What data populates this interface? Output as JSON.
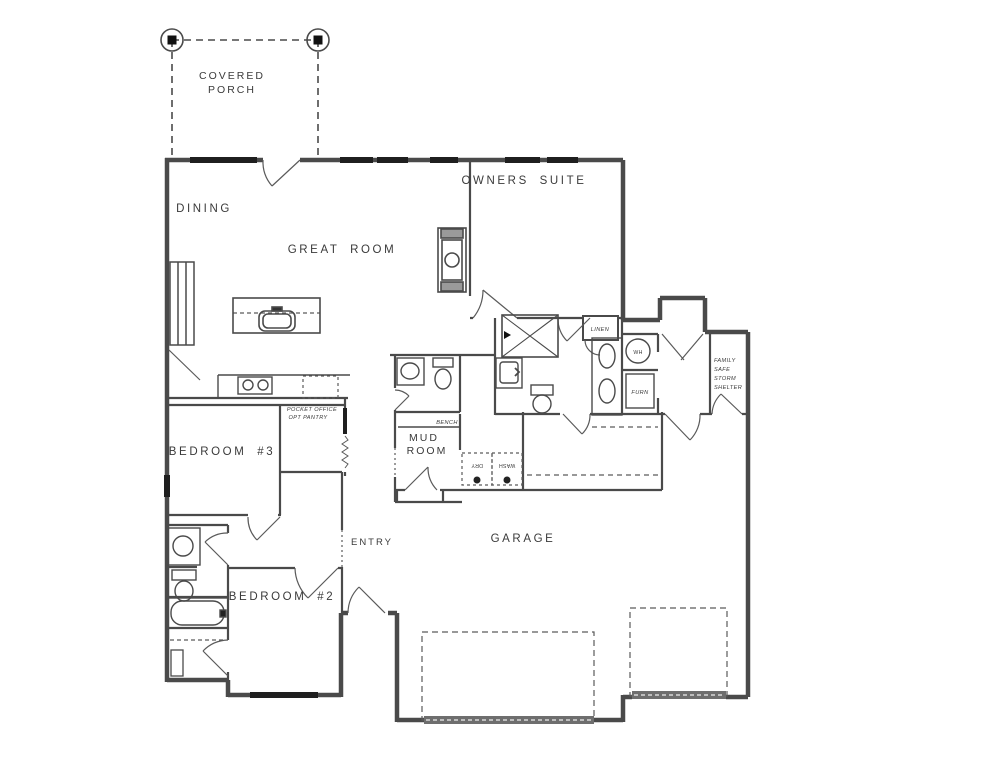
{
  "drawing_type": "residential floor plan",
  "labels": {
    "covered_porch": [
      "COVERED",
      "PORCH"
    ],
    "dining": "DINING",
    "great_room": "GREAT ROOM",
    "owners_suite": "OWNERS SUITE",
    "bedroom_3": "BEDROOM #3",
    "bedroom_2": "BEDROOM #2",
    "mud_room": [
      "MUD",
      "ROOM"
    ],
    "bench": "BENCH",
    "entry": "ENTRY",
    "garage": "GARAGE",
    "linen": "LINEN",
    "water_heater": "WH",
    "furnace": "FURN",
    "dryer": "DRY",
    "washer": "WASH",
    "pocket_office": [
      "POCKET OFFICE",
      "OPT PANTRY"
    ],
    "storm_shelter": [
      "FAMILY",
      "SAFE",
      "STORM",
      "SHELTER"
    ]
  },
  "colors": {
    "wall_line": "#4a4a4a",
    "window_fill": "#1f1f1f",
    "text": "#3a3a3a",
    "background": "#ffffff",
    "garage_door_band": "#6e6e6e"
  }
}
